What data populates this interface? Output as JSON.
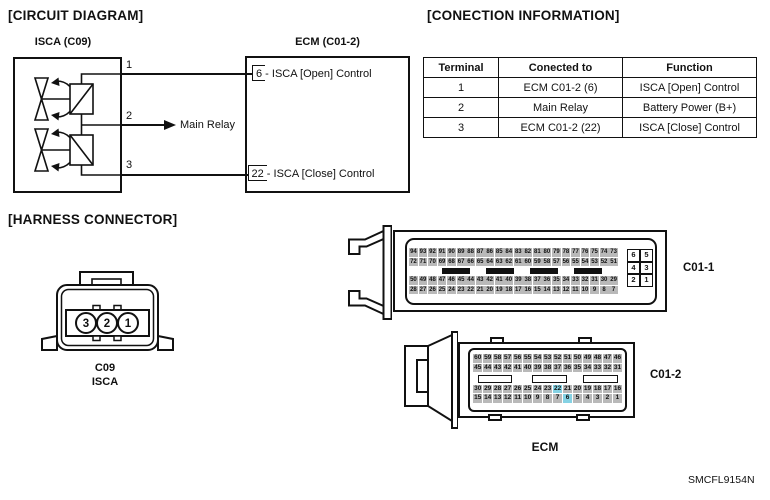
{
  "doc_code": "SMCFL9154N",
  "colors": {
    "line": "#111111",
    "pin_fill": "#b9b9b9",
    "pin_highlight": "#85d2e4"
  },
  "circuit": {
    "section_title": "[CIRCUIT DIAGRAM]",
    "isca_box_label": "ISCA (C09)",
    "ecm_box_label": "ECM (C01-2)",
    "terminal1": "1",
    "terminal2": "2",
    "terminal3": "3",
    "main_relay_label": "Main Relay",
    "ecm_pin_open": "6 - ISCA [Open] Control",
    "ecm_pin_close": "22 - ISCA [Close] Control"
  },
  "connection_info": {
    "section_title": "[CONECTION INFORMATION]",
    "headers": [
      "Terminal",
      "Conected to",
      "Function"
    ],
    "rows": [
      [
        "1",
        "ECM C01-2 (6)",
        "ISCA [Open] Control"
      ],
      [
        "2",
        "Main Relay",
        "Battery Power (B+)"
      ],
      [
        "3",
        "ECM C01-2 (22)",
        "ISCA [Close] Control"
      ]
    ]
  },
  "harness": {
    "section_title": "[HARNESS CONNECTOR]",
    "connector_code": "C09",
    "connector_name": "ISCA",
    "pins": [
      "3",
      "2",
      "1"
    ]
  },
  "ecm": {
    "caption": "ECM",
    "c01_1": {
      "label": "C01-1",
      "grid": {
        "rows": [
          [
            94,
            93,
            92,
            91,
            90,
            89,
            88,
            87,
            86,
            85,
            84,
            83,
            82,
            81,
            80,
            79,
            78,
            77,
            76,
            75,
            74,
            73
          ],
          [
            72,
            71,
            70,
            69,
            68,
            67,
            66,
            65,
            64,
            63,
            62,
            61,
            60,
            59,
            58,
            57,
            56,
            55,
            54,
            53,
            52,
            51
          ],
          [
            50,
            49,
            48,
            47,
            46,
            45,
            44,
            43,
            42,
            41,
            40,
            39,
            38,
            37,
            36,
            35,
            34,
            33,
            32,
            31,
            30,
            29
          ],
          [
            28,
            27,
            26,
            25,
            24,
            23,
            22,
            21,
            20,
            19,
            18,
            17,
            16,
            15,
            14,
            13,
            12,
            11,
            10,
            9,
            8,
            7
          ]
        ],
        "highlighted": []
      },
      "side_block": {
        "rows": [
          [
            "6",
            "5"
          ],
          [
            "4",
            "3"
          ],
          [
            "2",
            "1"
          ]
        ],
        "highlighted": []
      }
    },
    "c01_2": {
      "label": "C01-2",
      "grid": {
        "rows": [
          [
            60,
            59,
            58,
            57,
            56,
            55,
            54,
            53,
            52,
            51,
            50,
            49,
            48,
            47,
            46
          ],
          [
            45,
            44,
            43,
            42,
            41,
            40,
            39,
            38,
            37,
            36,
            35,
            34,
            33,
            32,
            31
          ],
          [
            30,
            29,
            28,
            27,
            26,
            25,
            24,
            23,
            22,
            21,
            20,
            19,
            18,
            17,
            16
          ],
          [
            15,
            14,
            13,
            12,
            11,
            10,
            9,
            8,
            7,
            6,
            5,
            4,
            3,
            2,
            1
          ]
        ],
        "highlighted": [
          22,
          6
        ]
      }
    }
  }
}
